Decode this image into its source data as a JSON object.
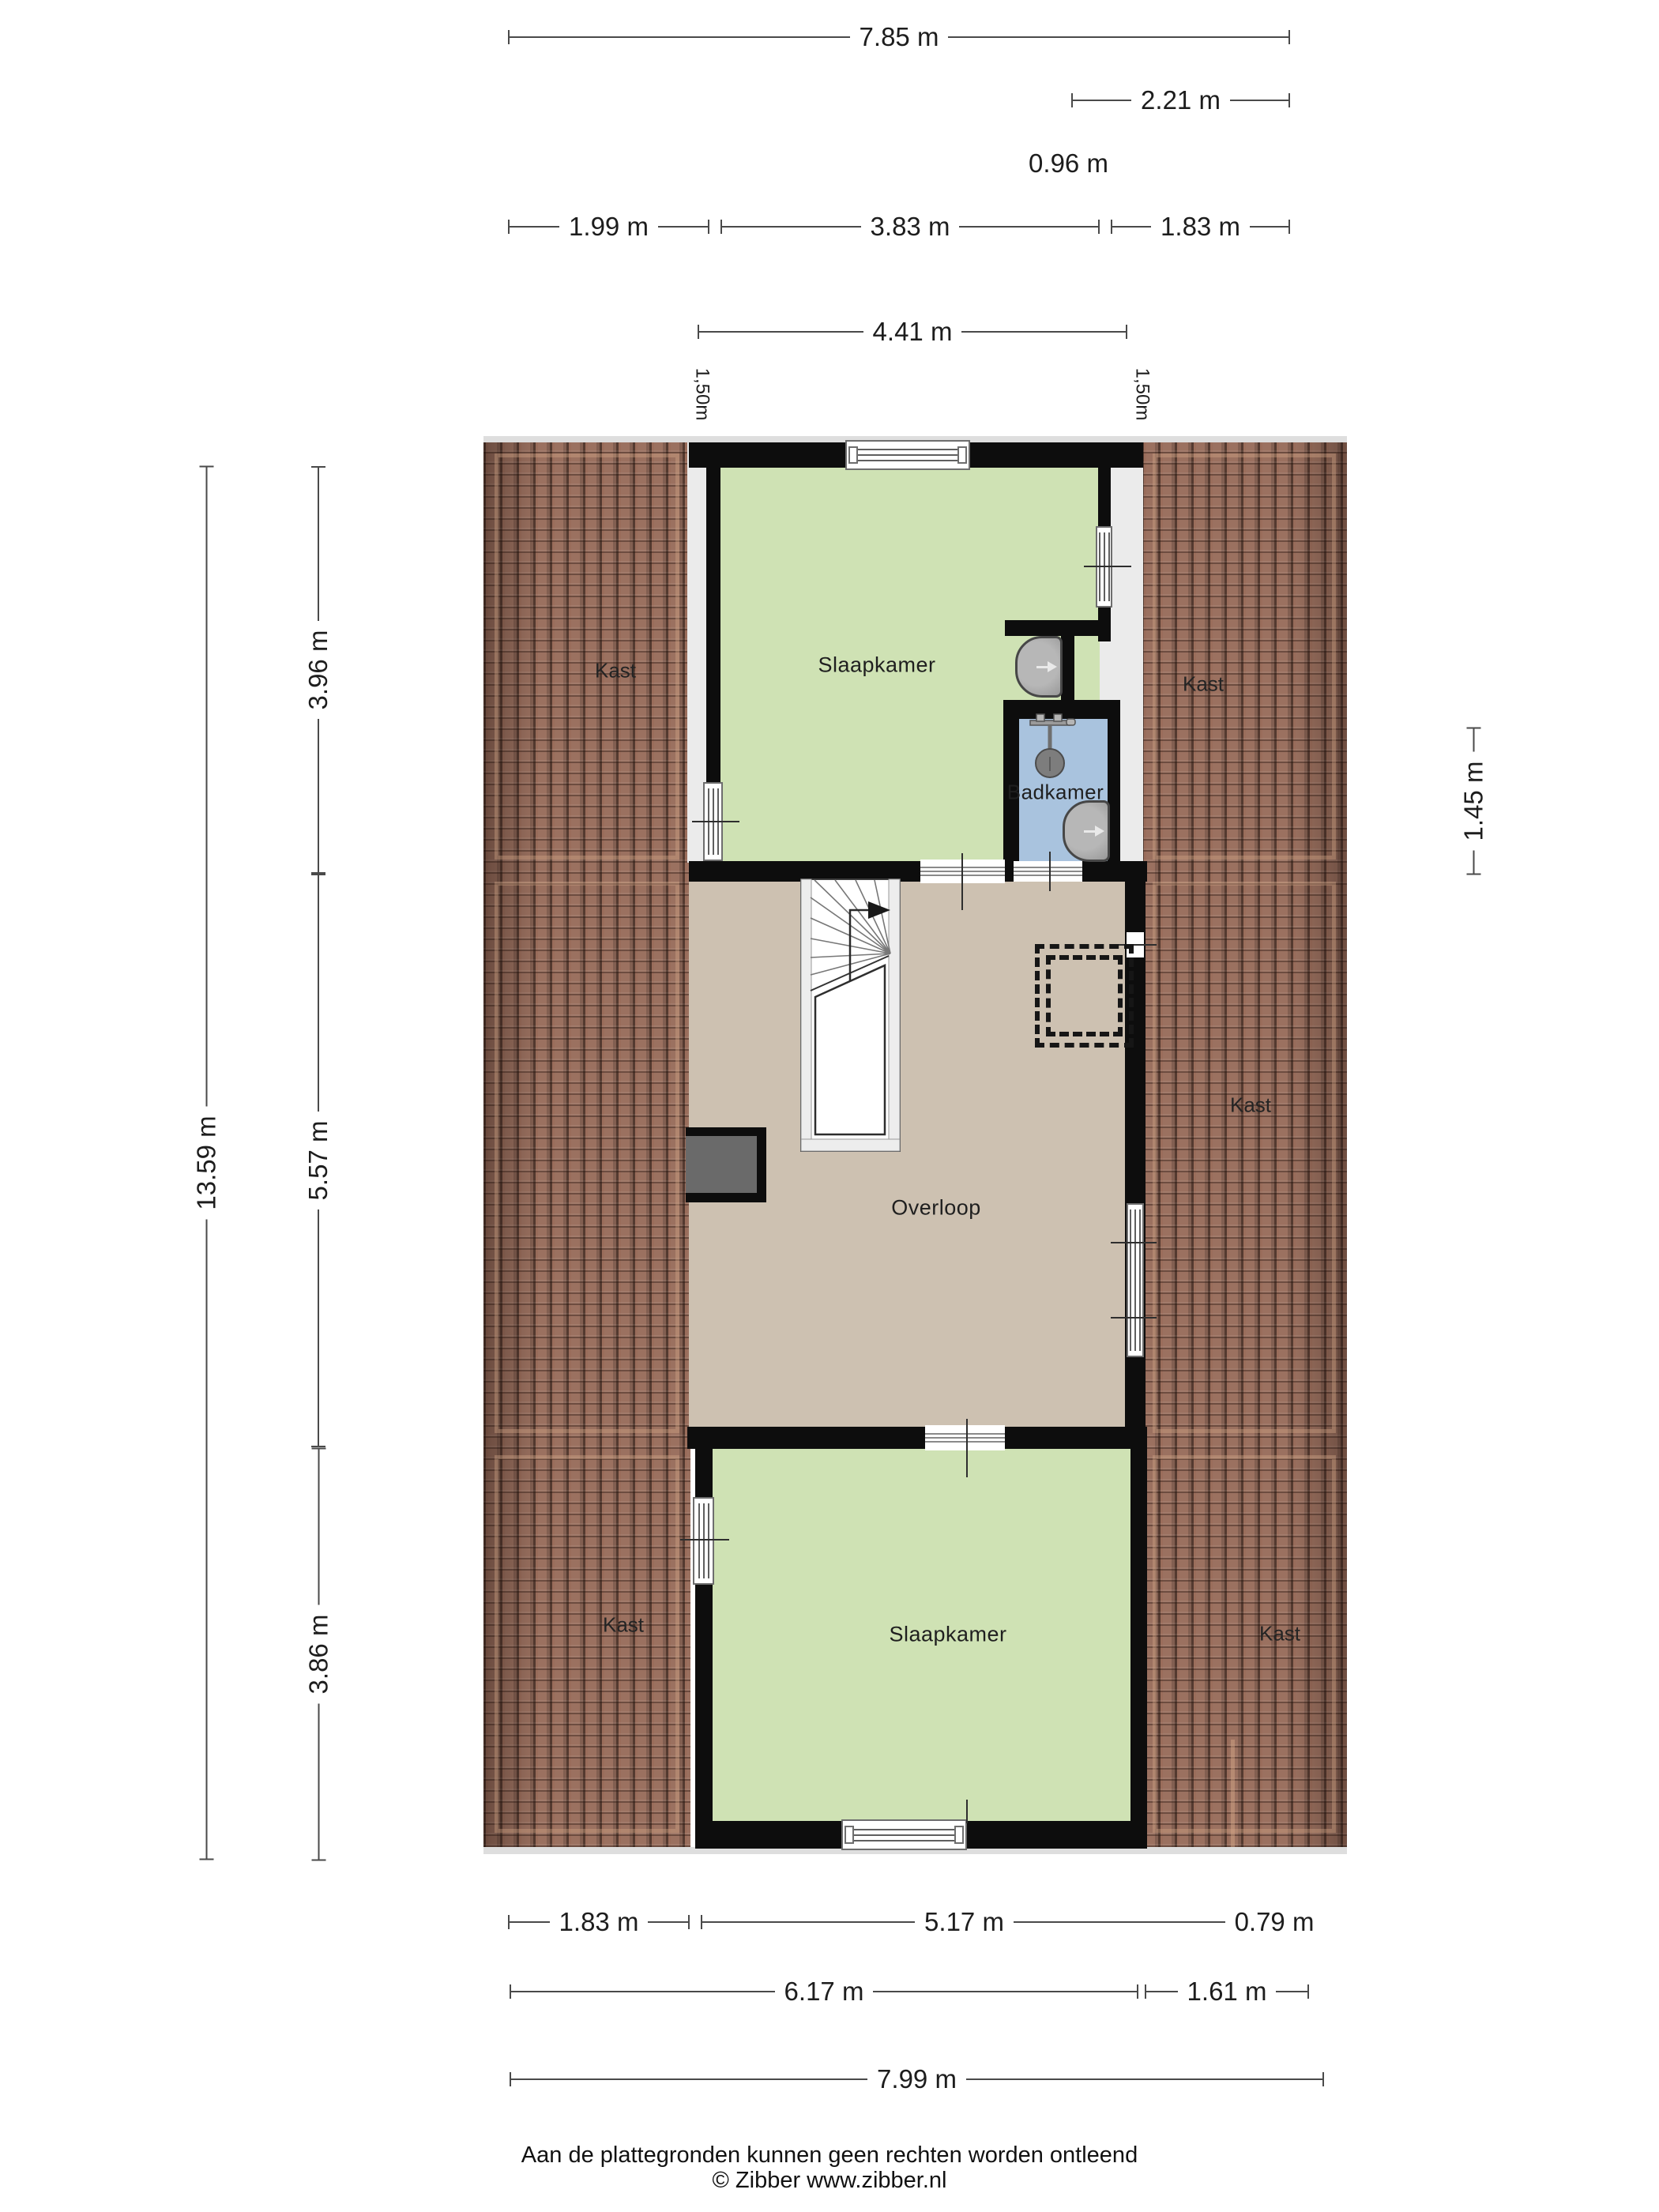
{
  "title": "Floor plan (verdieping) - Zibber plattegrond",
  "rooms": {
    "slaapkamer_top": "Slaapkamer",
    "badkamer": "Badkamer",
    "overloop": "Overloop",
    "slaapkamer_bottom": "Slaapkamer",
    "kast_top_left": "Kast",
    "kast_top_right": "Kast",
    "kast_mid_right": "Kast",
    "kast_bottom_left": "Kast",
    "kast_bottom_right": "Kast"
  },
  "dims": {
    "d785": "7.85 m",
    "d221": "2.21 m",
    "d096": "0.96 m",
    "d199": "1.99 m",
    "d383": "3.83 m",
    "d183top": "1.83 m",
    "d441": "4.41 m",
    "d150l": "1,50m",
    "d150r": "1,50m",
    "d1359": "13.59 m",
    "d396": "3.96 m",
    "d557": "5.57 m",
    "d386": "3.86 m",
    "d145": "1.45 m",
    "d183bot": "1.83 m",
    "d517": "5.17 m",
    "d079": "0.79 m",
    "d617": "6.17 m",
    "d161": "1.61 m",
    "d799": "7.99 m"
  },
  "footer": {
    "line1": "Aan de plattegronden kunnen geen rechten worden ontleend",
    "line2": "© Zibber www.zibber.nl"
  },
  "colors": {
    "bedroom_fill": "#cfe2b4",
    "bathroom_fill": "#a9c3de",
    "landing_fill": "#cdc1b1",
    "roof_tile": "#9b7160",
    "wall": "#0d0d0d",
    "dimension_line": "#4a4a4a"
  }
}
